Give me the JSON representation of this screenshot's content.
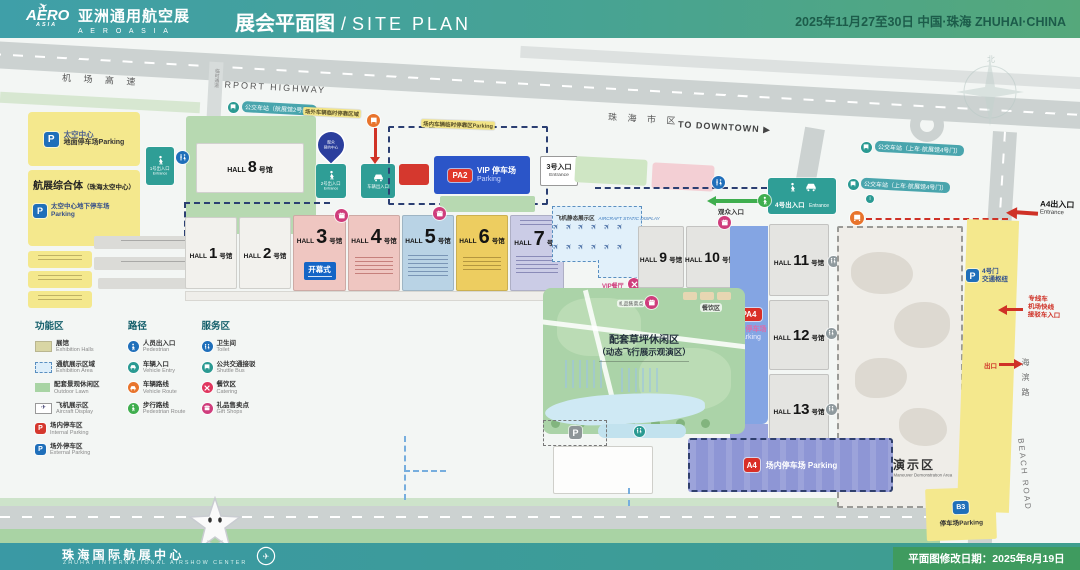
{
  "header": {
    "logo_badge": "AERO",
    "logo_badge_sub": "ASIA",
    "logo_plane": "✈",
    "logo_cn": "亚洲通用航空展",
    "logo_en": "A E R O   A S I A",
    "title_cn": "展会平面图",
    "title_sep": "/",
    "title_en": "SITE PLAN",
    "date": "2025年11月27至30日  中国·珠海  ZHUHAI·CHINA"
  },
  "roads": {
    "highway_cn": "机 场 高 速",
    "highway_en": "AIRPORT HIGHWAY",
    "downtown_cn": "珠 海 市 区",
    "downtown_en": "TO DOWNTOWN ▶",
    "beach_cn": "海滨路",
    "beach_en": "BEACH ROAD",
    "temp": "临时通道"
  },
  "bus": {
    "b1": "公交车站（航展馆2号门）",
    "b2": "公交车站（上车·航展馆4号门）",
    "b3": "公交车站（上车·航展馆4号门）"
  },
  "halls": {
    "word": "HALL",
    "unit": "号馆",
    "nums": [
      "1",
      "2",
      "3",
      "4",
      "5",
      "6",
      "7",
      "8",
      "9",
      "10",
      "11",
      "12",
      "13"
    ]
  },
  "areas": {
    "space_parking_l1": "太空中心",
    "space_parking_l2": "地面停车场Parking",
    "complex_title": "航展综合体",
    "complex_sub": "（珠海太空中心）",
    "underground_l1": "太空中心地下停车场",
    "underground_l2": "Parking",
    "roadside1": "场外车辆临时停靠区域",
    "roadside2": "场内车辆临时停靠区Parking",
    "vip_badge": "PA2",
    "vip_l1": "VIP 停车场",
    "vip_l2": "Parking",
    "pa4_badge": "PA4",
    "pa4_l1": "场内停车场",
    "pa4_l2": "Parking",
    "a4p_badge": "A4",
    "a4p_label": "场内停车场 Parking",
    "opening": "开幕式",
    "aircraft_cn": "飞机静态展示区",
    "aircraft_en": "AIRCRAFT STATIC DISPLAY",
    "plane": "✈",
    "vip_rest": "VIP餐厅",
    "catering": "餐饮区",
    "gift_label": "礼品售卖点",
    "lawn_l1": "配套草坪休闲区",
    "lawn_l2": "（动态飞行展示观演区）",
    "equip_cn": "装备演示区",
    "equip_en": "Ground Equipment Maneuver Demonstration Area",
    "hub_l1": "4号门",
    "hub_l2": "交通枢纽",
    "b3_badge": "B3",
    "b3_label": "停车场Parking",
    "pin_l1": "观众",
    "pin_l2": "预约中心"
  },
  "entrances": {
    "e1_l1": "1号出入口",
    "e1_l2": "Entrance",
    "e2_l1": "2号出入口",
    "e2_l2": "Entrance",
    "veh": "车辆出入口",
    "e3_l1": "3号入口",
    "e3_l2": "Entrance",
    "e4_l1": "4号出入口",
    "e4_l2": "Entrance",
    "a4_l1": "A4出入口",
    "a4_l2": "Entrance",
    "visitor": "观众入口",
    "exit": "出口",
    "shuttle_l1": "专线车",
    "shuttle_l2": "机场快线",
    "shuttle_l3": "接驳车入口"
  },
  "legend": {
    "t1": "功能区",
    "t2": "路径",
    "t3": "服务区",
    "col1": [
      {
        "cn": "展馆",
        "en": "Exhibition Halls"
      },
      {
        "cn": "通航展示区域",
        "en": "Exhibition Area"
      },
      {
        "cn": "配套景观休闲区",
        "en": "Outdoor Lawn"
      },
      {
        "cn": "飞机展示区",
        "en": "Aircraft Display"
      },
      {
        "cn": "场内停车区",
        "en": "Internal Parking"
      },
      {
        "cn": "场外停车区",
        "en": "External Parking"
      }
    ],
    "col2": [
      {
        "cn": "人员出入口",
        "en": "Pedestrian"
      },
      {
        "cn": "车辆入口",
        "en": "Vehicle Entry"
      },
      {
        "cn": "车辆路线",
        "en": "Vehicle Route"
      },
      {
        "cn": "步行路线",
        "en": "Pedestrian Route"
      }
    ],
    "col3": [
      {
        "cn": "卫生间",
        "en": "Toilet"
      },
      {
        "cn": "公共交通接驳",
        "en": "Shuttle Bus"
      },
      {
        "cn": "餐饮区",
        "en": "Catering"
      },
      {
        "cn": "礼品售卖点",
        "en": "Gift Shops"
      }
    ]
  },
  "footer": {
    "center_cn": "珠 海 国 际 航 展 中 心",
    "center_en": "ZHUHAI INTERNATIONAL AIRSHOW CENTER",
    "revision": "平面图修改日期：2025年8月19日"
  },
  "colors": {
    "teal": "#2f9e96",
    "blue_p": "#1f6fba",
    "red": "#d5382e",
    "magenta": "#cf3d7c",
    "orange": "#e8742c",
    "green_route": "#3fae4e"
  }
}
